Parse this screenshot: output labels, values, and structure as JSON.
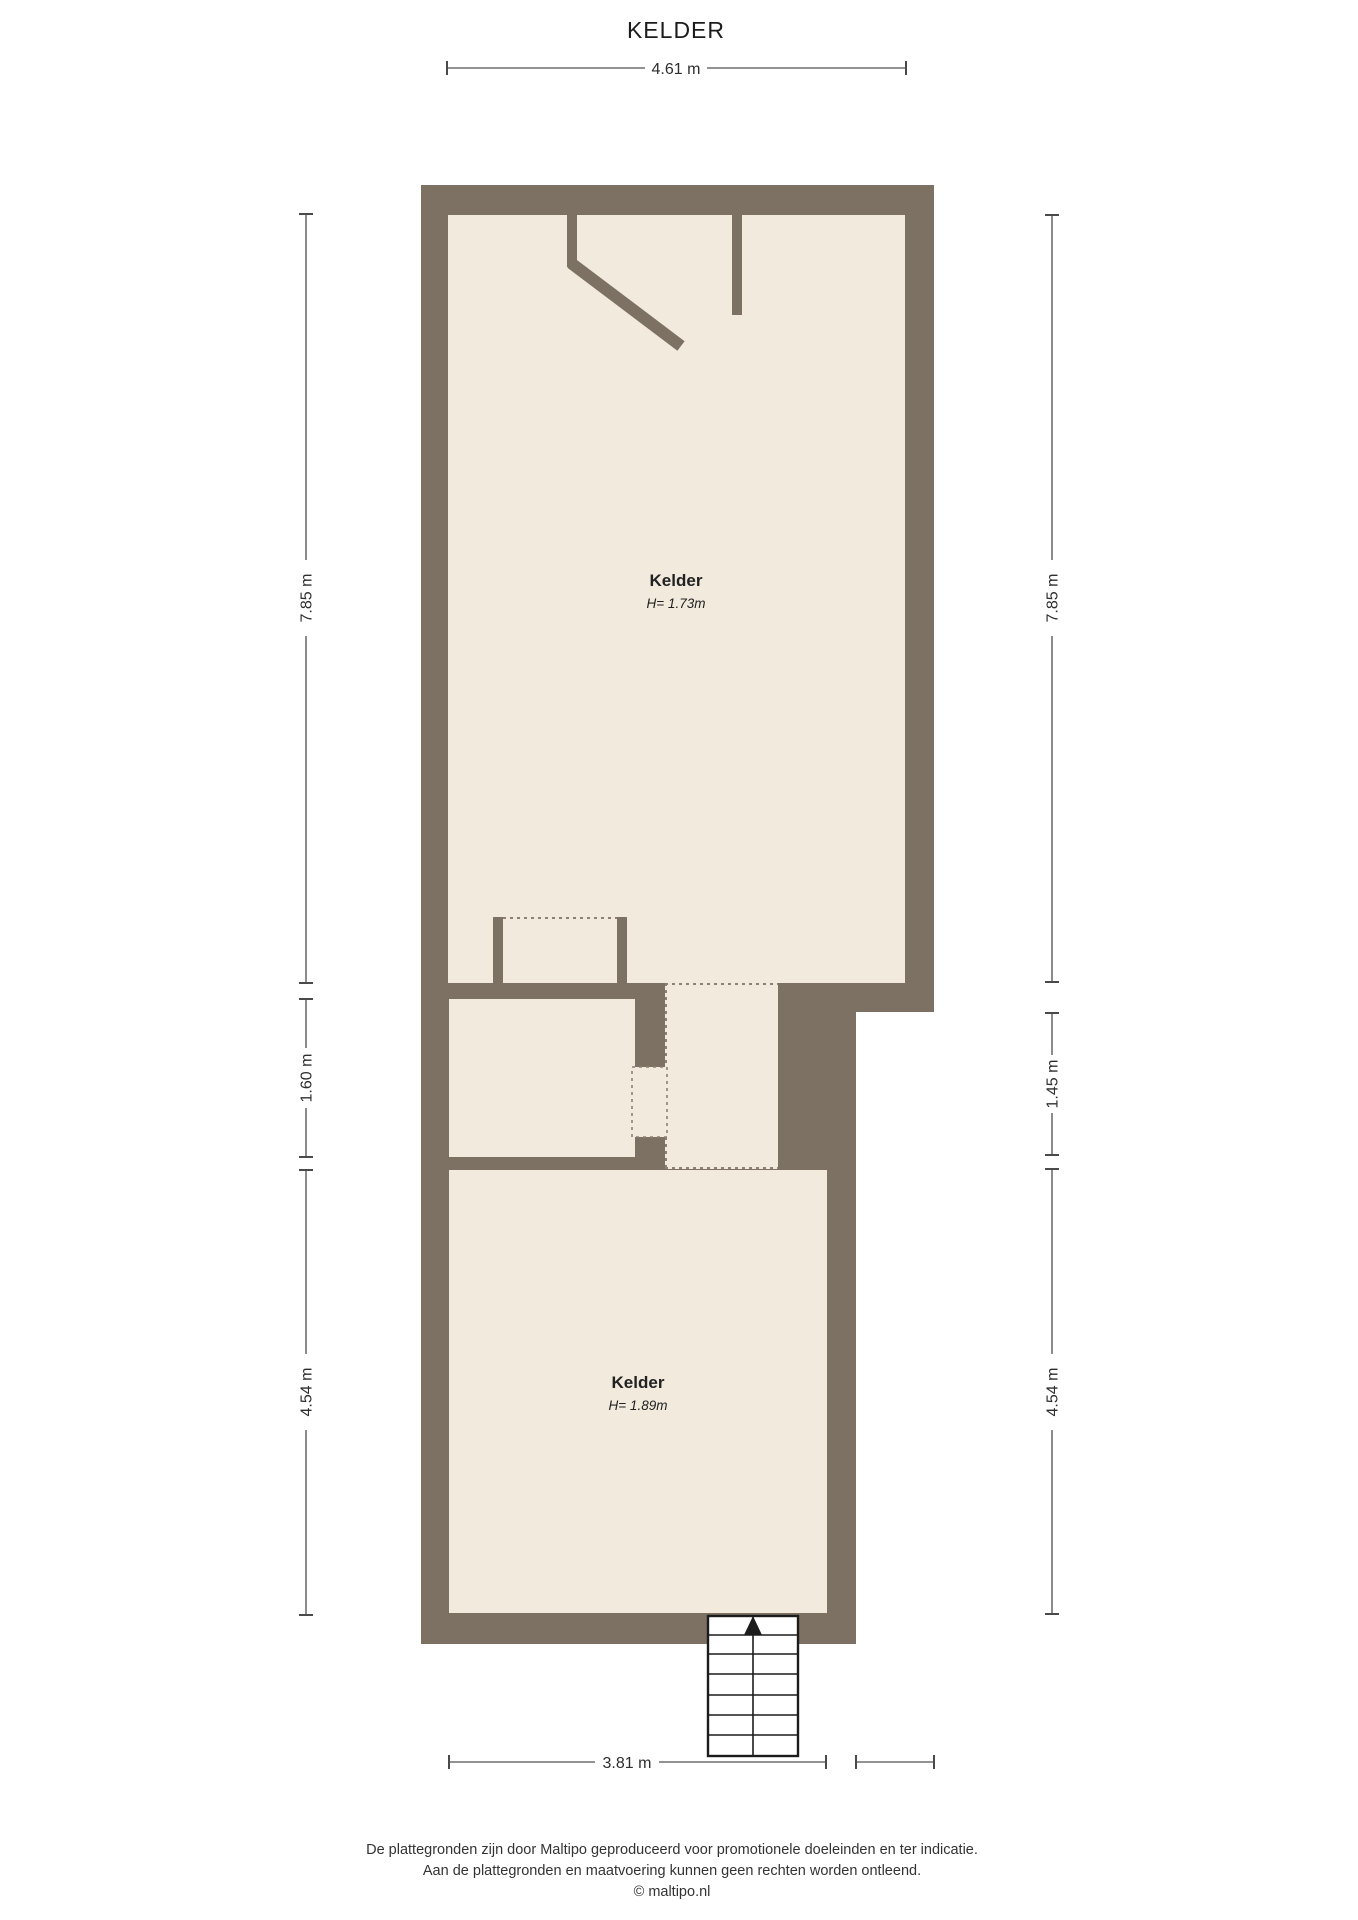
{
  "page_title": "KELDER",
  "colors": {
    "wall": "#7d7164",
    "floor": "#f2eadd",
    "dashed_line": "#8c8173",
    "dimension_line": "#6e6e6e",
    "text": "#1c1c1c",
    "stairs_fill": "#ffffff",
    "background": "#ffffff"
  },
  "rooms": [
    {
      "label": "Kelder",
      "height": "H= 1.73m"
    },
    {
      "label": "Kelder",
      "height": "H= 1.89m"
    }
  ],
  "dimensions": {
    "top": "4.61 m",
    "left_top": "7.85 m",
    "left_middle": "1.60 m",
    "left_bottom": "4.54 m",
    "right_top": "7.85 m",
    "right_middle": "1.45 m",
    "right_bottom": "4.54 m",
    "bottom": "3.81 m"
  },
  "footer": {
    "line1": "De plattegronden zijn door Maltipo geproduceerd voor promotionele doeleinden en ter indicatie.",
    "line2": "Aan de plattegronden en maatvoering kunnen geen rechten worden ontleend.",
    "line3": "© maltipo.nl"
  }
}
